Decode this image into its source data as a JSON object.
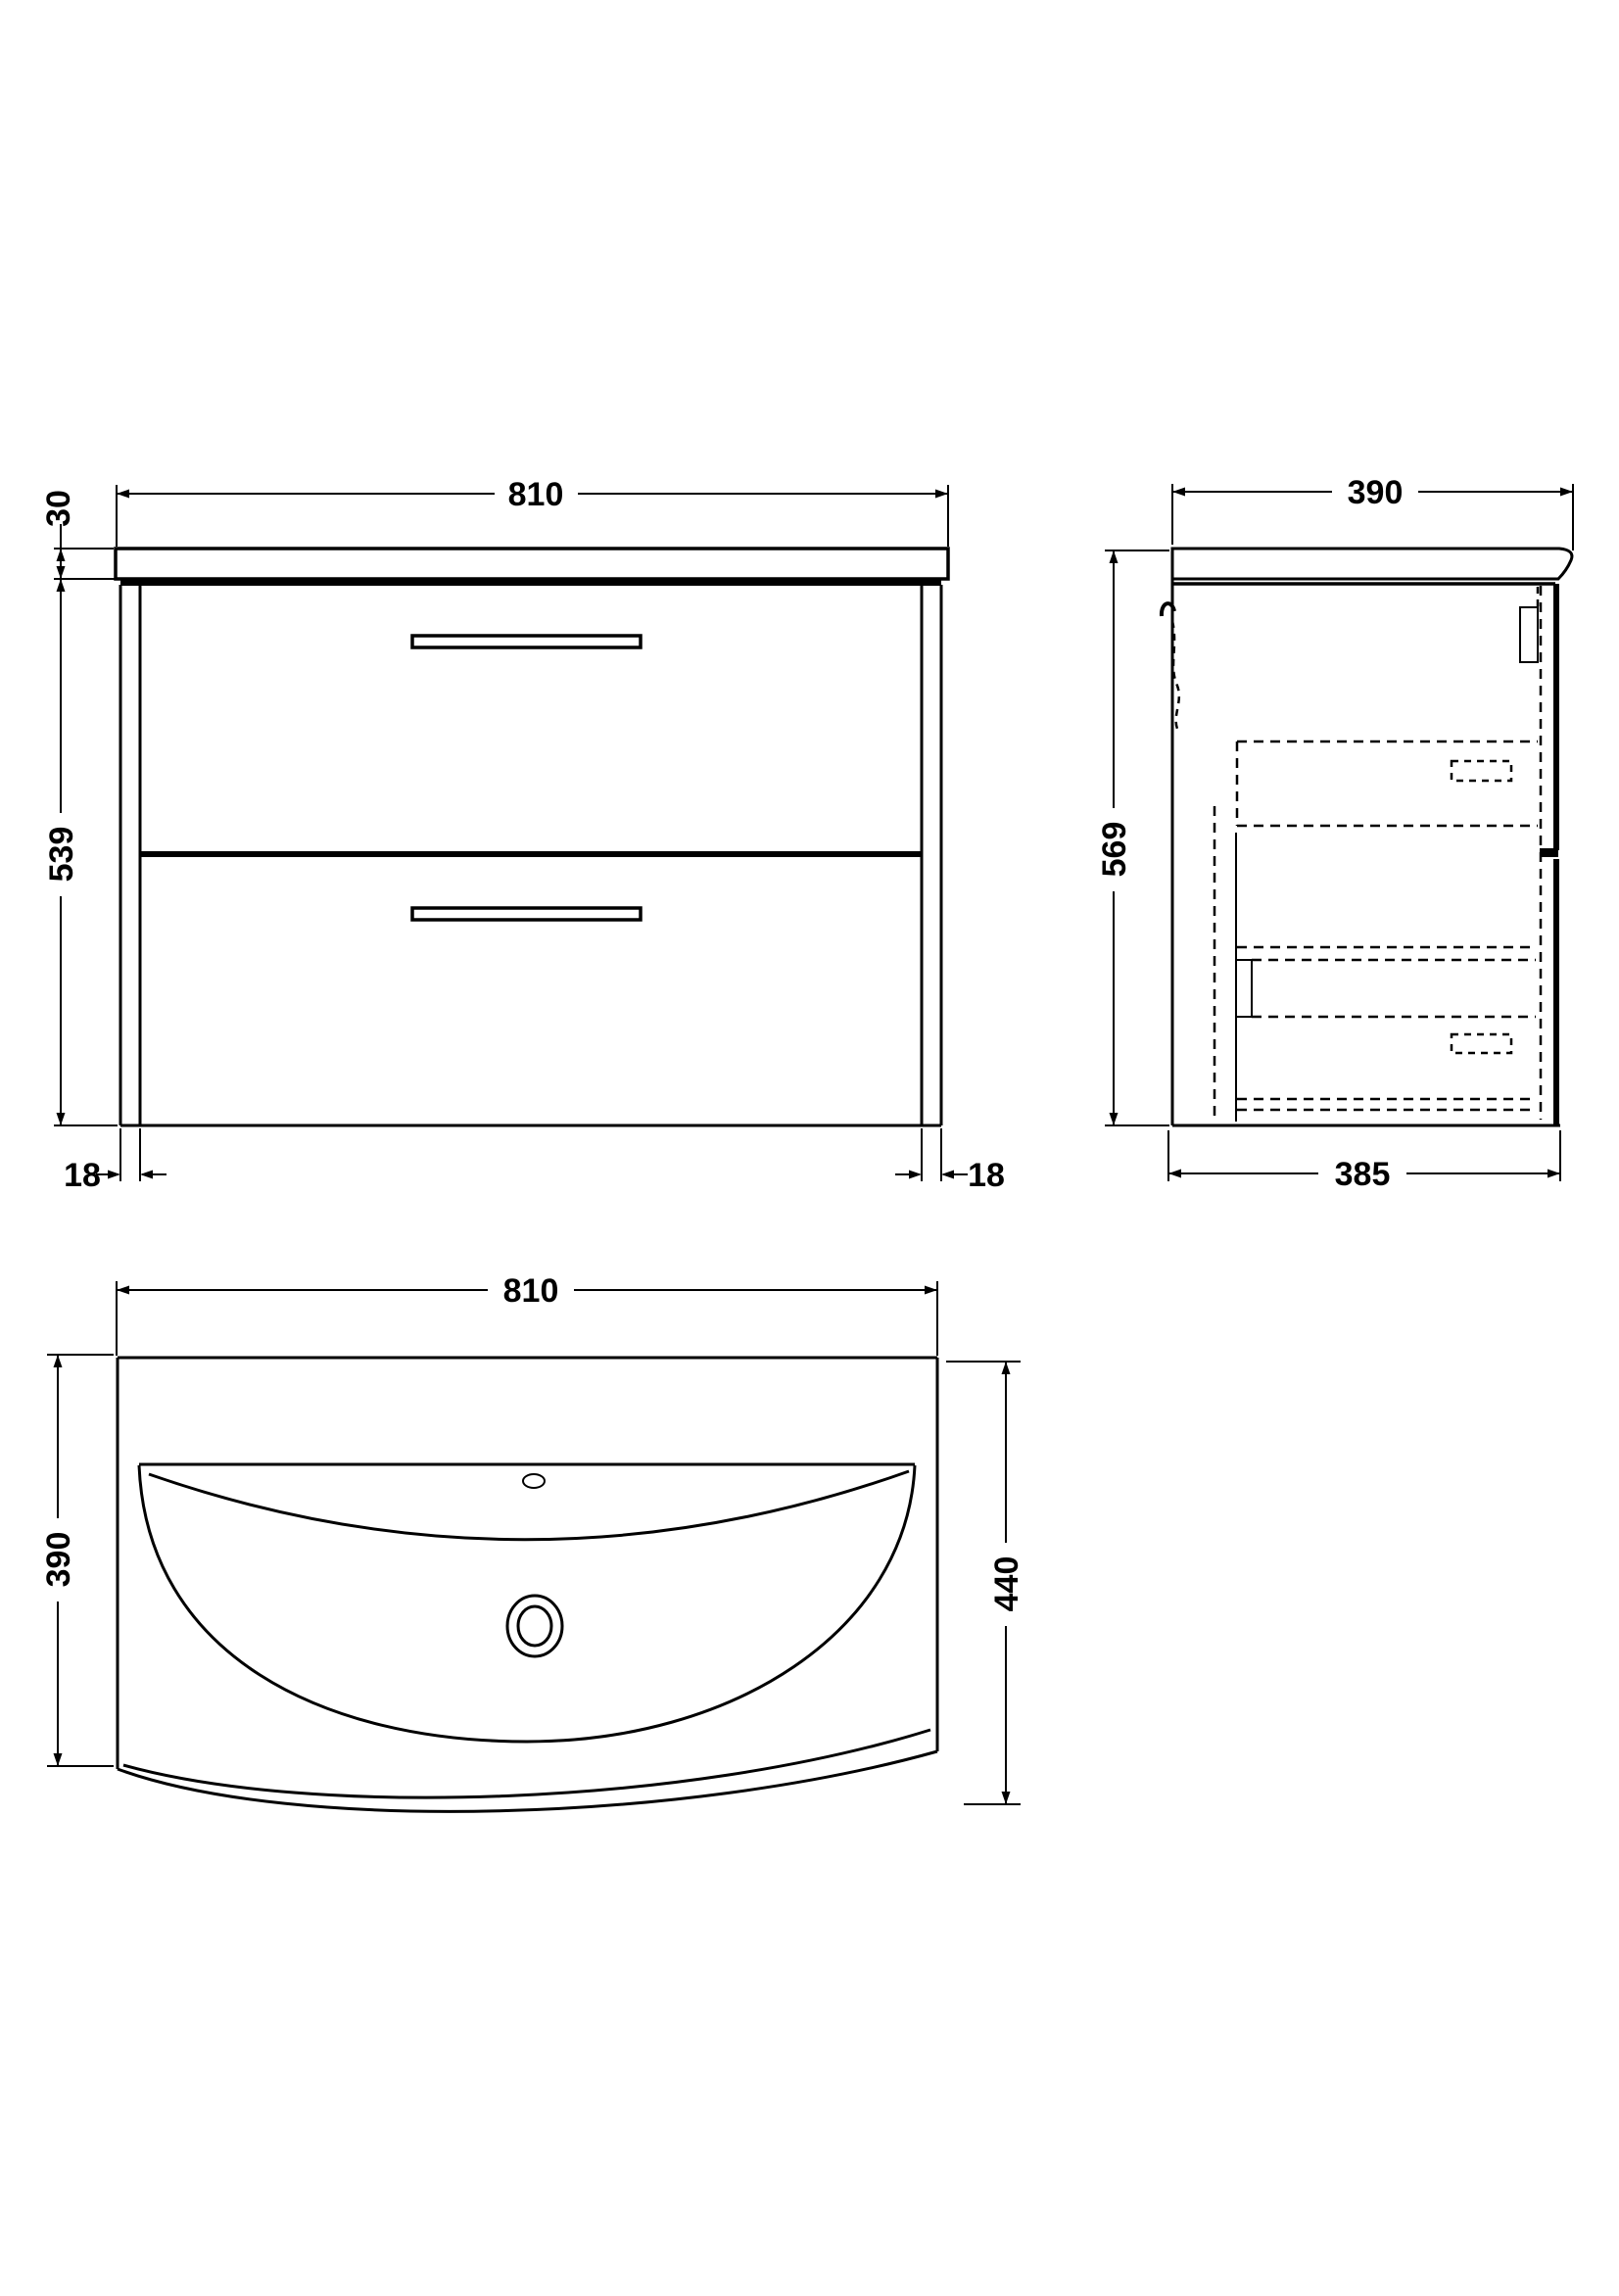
{
  "drawing": {
    "front_view": {
      "width": "810",
      "worktop_thickness": "30",
      "cabinet_height": "539",
      "left_panel_thickness": "18",
      "right_panel_thickness": "18"
    },
    "side_view": {
      "depth": "390",
      "height": "569",
      "cabinet_depth": "385"
    },
    "basin_view": {
      "width": "810",
      "basin_depth": "390",
      "overall_depth": "440"
    }
  },
  "colors": {
    "line": "#000000",
    "background": "#ffffff"
  }
}
